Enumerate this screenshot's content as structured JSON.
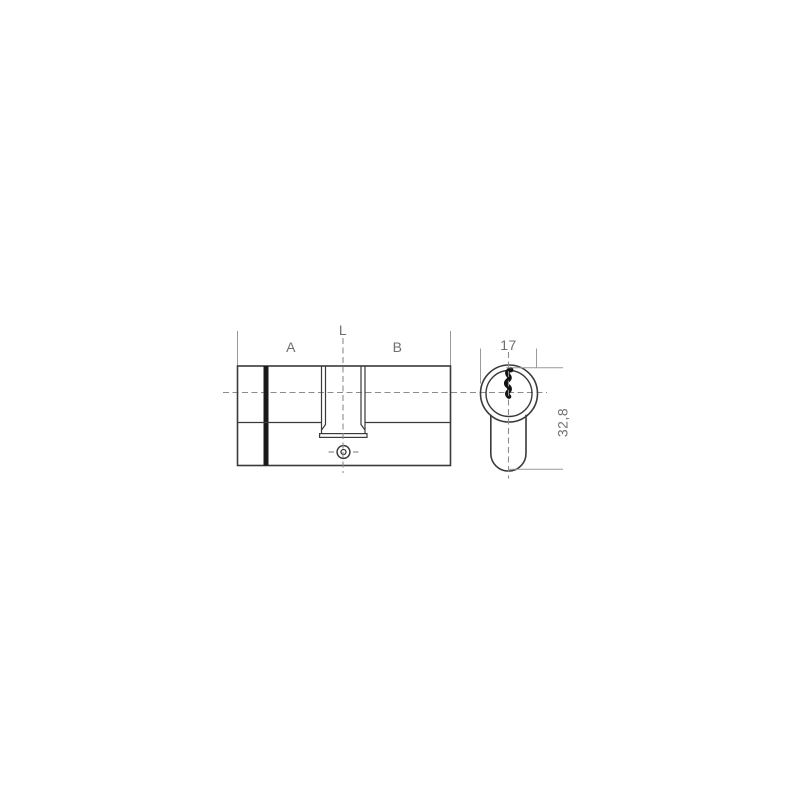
{
  "page": {
    "background": "#ffffff"
  },
  "diagram": {
    "type": "technical-drawing",
    "subject": "euro-profile-double-lock-cylinder",
    "views": {
      "side_view": "cylinder side elevation with cam slot and fixing screw",
      "front_view": "euro profile face view with keyway"
    },
    "labels": {
      "length_left": "A",
      "length_total": "L",
      "length_right": "B",
      "profile_width": "17",
      "profile_height": "32,8"
    },
    "colors": {
      "outline": "#3a3a3a",
      "dimension_line": "#9a9a9a",
      "centerline": "#8c8c8c",
      "label_text": "#6f6f6f",
      "keyway_fill": "#121212",
      "background": "#ffffff"
    }
  }
}
